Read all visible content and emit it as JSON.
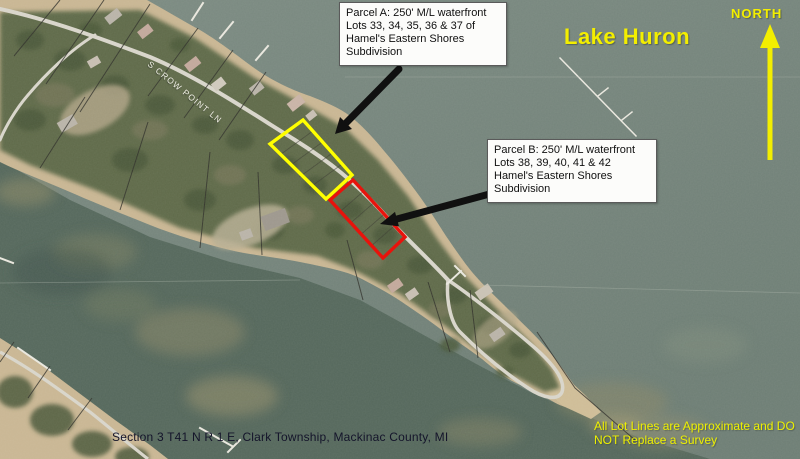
{
  "annotations": {
    "parcel_a_box": {
      "line1": "Parcel A: 250' M/L waterfront",
      "line2": "Lots 33, 34, 35, 36 & 37 of",
      "line3": "Hamel's Eastern Shores",
      "line4": "Subdivision"
    },
    "parcel_b_box": {
      "line1": "Parcel B: 250' M/L waterfront",
      "line2": "Lots 38, 39, 40, 41 & 42",
      "line3": "Hamel's Eastern Shores",
      "line4": "Subdivision"
    },
    "lake_label": "Lake Huron",
    "north_label": "NORTH",
    "road_label": "S CROW POINT LN",
    "caption": "Section 3 T41 N R 1 E, Clark Township, Mackinac County, MI",
    "disclaimer": {
      "line1": "All Lot Lines are Approximate and DO",
      "line2": "NOT Replace a Survey"
    },
    "colors": {
      "parcel_a_outline": "#ffff00",
      "parcel_b_outline": "#e8130c",
      "label_yellow": "#f3ee00",
      "arrow_black": "#101010"
    }
  }
}
